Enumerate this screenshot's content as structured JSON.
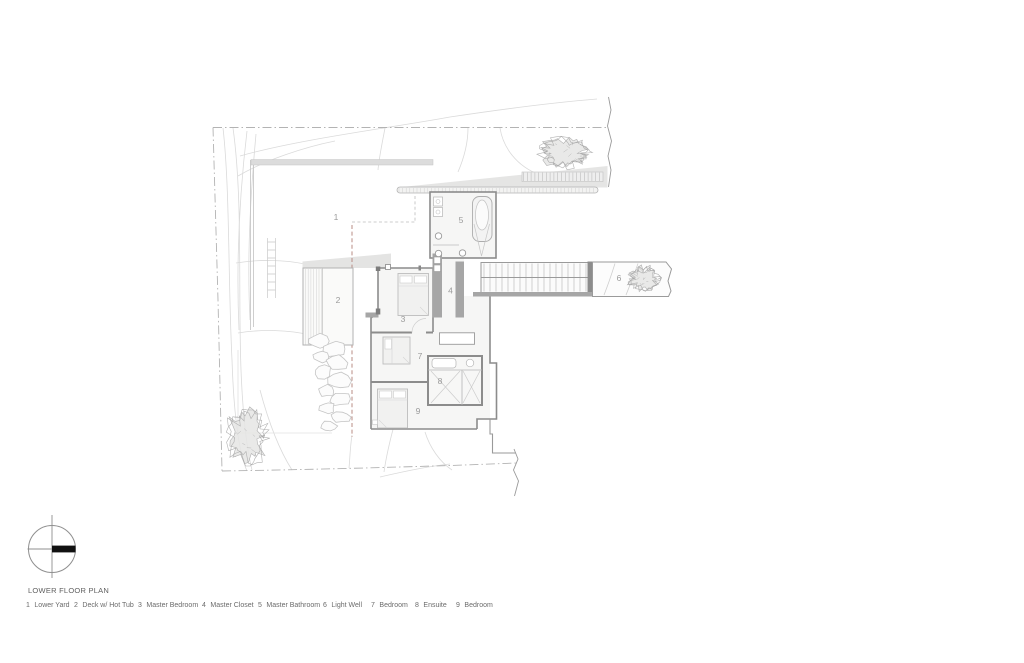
{
  "drawing": {
    "title": "LOWER FLOOR PLAN",
    "rooms": [
      {
        "num": "1",
        "name": "Lower Yard"
      },
      {
        "num": "2",
        "name": "Deck w/ Hot Tub"
      },
      {
        "num": "3",
        "name": "Master Bedroom"
      },
      {
        "num": "4",
        "name": "Master Closet"
      },
      {
        "num": "5",
        "name": "Master Bathroom"
      },
      {
        "num": "6",
        "name": "Light Well"
      },
      {
        "num": "7",
        "name": "Bedroom"
      },
      {
        "num": "8",
        "name": "Ensuite"
      },
      {
        "num": "9",
        "name": "Bedroom"
      }
    ]
  },
  "colors": {
    "wall": "#8c8c8c",
    "partition": "#a6a6a6",
    "thin_line": "#bdbdbd",
    "contour": "#dadada",
    "roof_shade": "#e4e4e3",
    "room_fill": "#f6f6f5",
    "tree": "#a3a3a3",
    "boulder": "#c5c5c5",
    "section_cut": "#b98c84",
    "boundary": "#b3b3b3",
    "legend_text": "#6b6b6b",
    "room_number": "#9b9b9b",
    "north_bar": "#111111"
  }
}
